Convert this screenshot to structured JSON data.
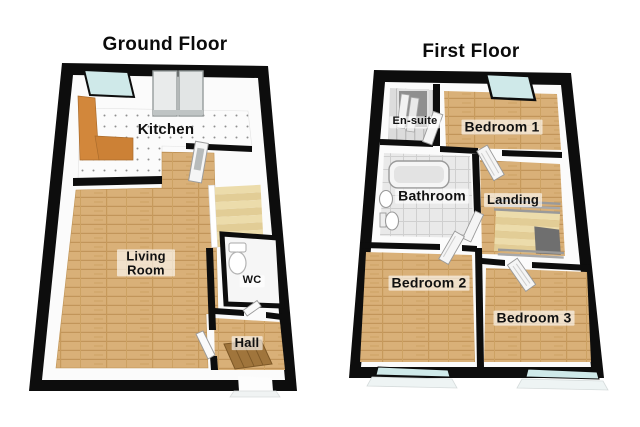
{
  "plans": [
    {
      "title": "Ground Floor",
      "rooms": [
        {
          "label": "Kitchen"
        },
        {
          "label": "Living Room"
        },
        {
          "label": "WC"
        },
        {
          "label": "Hall"
        }
      ],
      "fixtures": [
        "window",
        "patio-doors",
        "kitchen-counter",
        "kitchen-door",
        "staircase",
        "toilet",
        "door-mat",
        "front-door"
      ]
    },
    {
      "title": "First Floor",
      "rooms": [
        {
          "label": "En-suite"
        },
        {
          "label": "Bedroom 1"
        },
        {
          "label": "Bathroom"
        },
        {
          "label": "Landing"
        },
        {
          "label": "Bedroom 2"
        },
        {
          "label": "Bedroom 3"
        }
      ],
      "fixtures": [
        "shower",
        "bay-window",
        "bathtub",
        "sink",
        "toilet",
        "staircase-with-railing",
        "bedroom-windows"
      ]
    }
  ],
  "palette": {
    "wall": "#0d0d0d",
    "wood_floor": "#d8ab70",
    "kitchen_tile": "#f8f8f8",
    "bathroom_tile": "#e4e4e4",
    "counter": "#d2873b",
    "glass": "#cfe9e9",
    "stairs": "#e9d8a4",
    "door_mat": "#a0753c",
    "background": "#ffffff"
  }
}
